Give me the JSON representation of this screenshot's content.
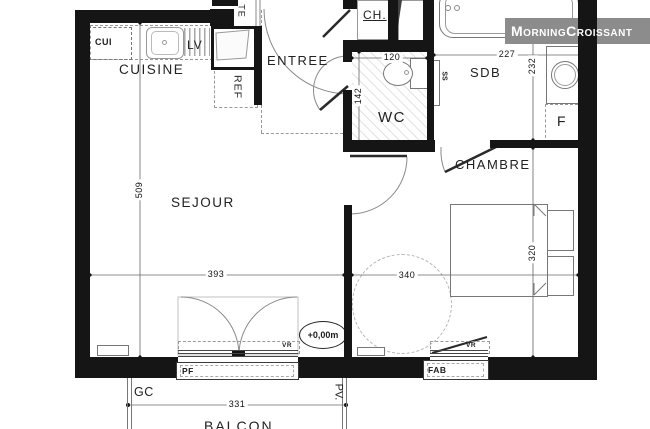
{
  "plan": {
    "watermark": "MorningCroissant",
    "level_marker": "+0,00m",
    "rooms": {
      "cuisine": "CUISINE",
      "sejour": "SEJOUR",
      "entree": "ENTREE",
      "wc": "WC",
      "sdb": "SDB",
      "chambre": "CHAMBRE",
      "balcon": "BALCON"
    },
    "labels": {
      "cui": "CUI",
      "lv": "LV",
      "te": "TE",
      "ref": "REF",
      "ch": "CH.",
      "ss": "SS",
      "f": "F",
      "pf": "PF",
      "fab": "FAB",
      "vr": "VR",
      "gc": "GC",
      "pv": "PV."
    },
    "dimensions_cm": {
      "sejour_height": "509",
      "sejour_width": "393",
      "wc_width": "120",
      "wc_depth": "142",
      "sdb_width": "227",
      "sdb_depth": "232",
      "chambre_width": "340",
      "chambre_depth": "320",
      "balcon_width": "331"
    },
    "colors": {
      "wall": "#151515",
      "watermark_bg": "#8c8c8c",
      "dash": "#999999"
    }
  }
}
